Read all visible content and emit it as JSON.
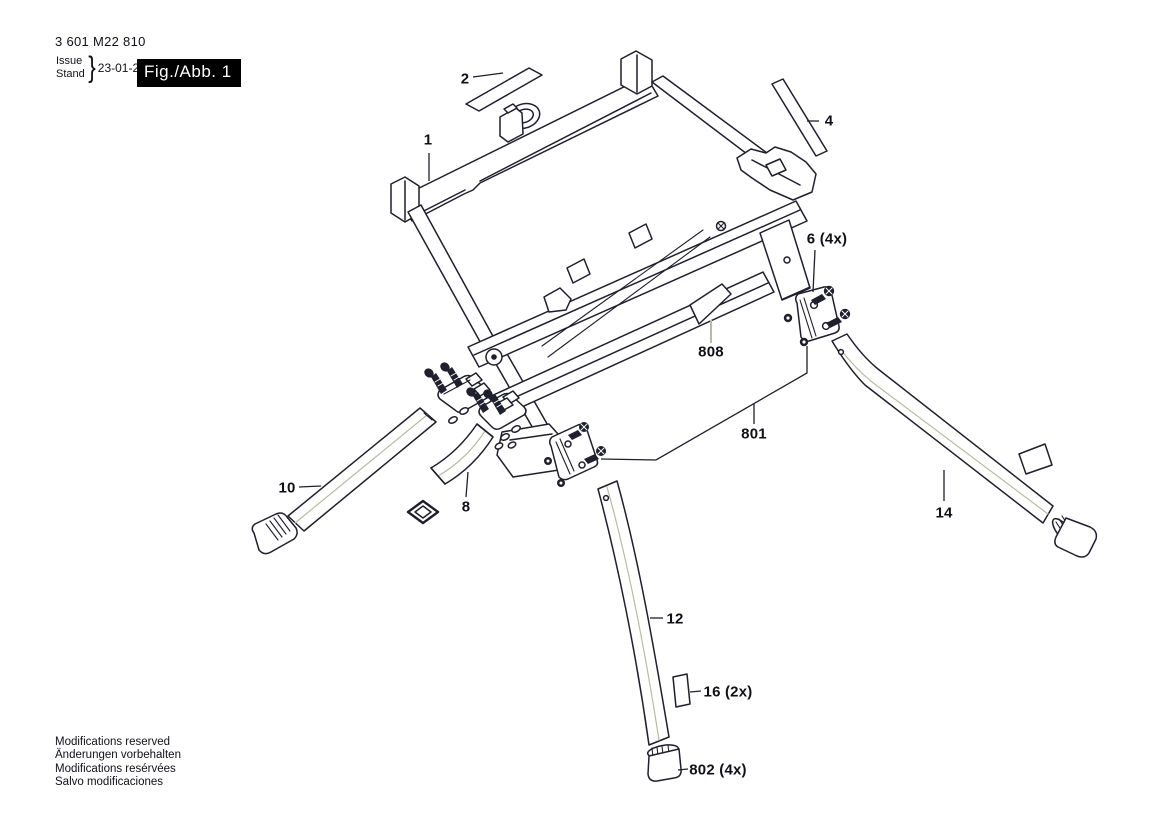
{
  "header": {
    "part_number": "3 601 M22 810",
    "issue_word": "Issue",
    "stand_word": "Stand",
    "brace": "}",
    "date": "23-01-20",
    "figure_label": "Fig./Abb. 1"
  },
  "callouts": {
    "c1": {
      "label": "1"
    },
    "c2": {
      "label": "2"
    },
    "c4": {
      "label": "4"
    },
    "c6": {
      "label": "6 (4x)"
    },
    "c8": {
      "label": "8"
    },
    "c10": {
      "label": "10"
    },
    "c12": {
      "label": "12"
    },
    "c14": {
      "label": "14"
    },
    "c16": {
      "label": "16 (2x)"
    },
    "c801": {
      "label": "801"
    },
    "c802": {
      "label": "802 (4x)"
    },
    "c808": {
      "label": "808"
    }
  },
  "footer": {
    "lines": [
      "Modifications reserved",
      "Änderungen vorbehalten",
      "Modifications resérvées",
      "Salvo modificaciones"
    ]
  },
  "colors": {
    "line": "#1f1f2d",
    "soft_leader": "#b9bca3",
    "text": "#101018",
    "figure_box_bg": "#000000",
    "figure_box_fg": "#ffffff",
    "background": "#ffffff"
  }
}
